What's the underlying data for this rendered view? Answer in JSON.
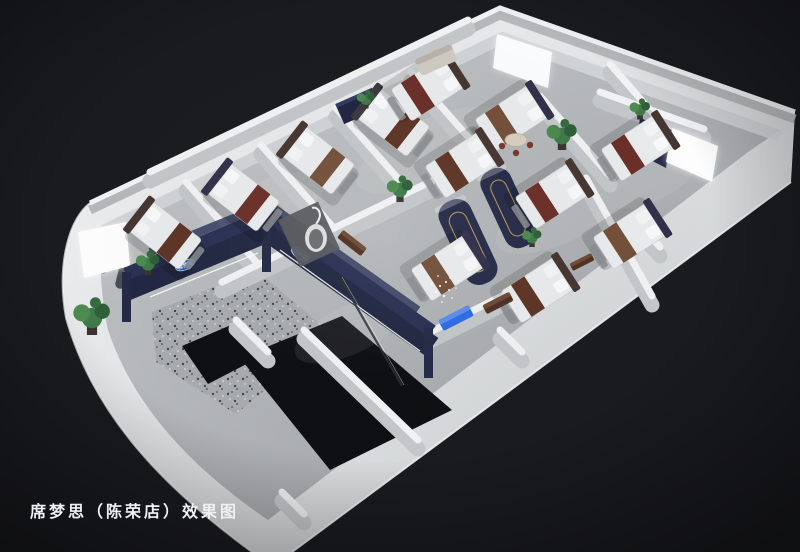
{
  "scene": {
    "type": "3d-cutaway-floorplan-rendering",
    "subject": "Overhead cutaway rendering of a mattress showroom with many bedroom displays",
    "brand": "席梦思",
    "branch": "陈荣店"
  },
  "caption": {
    "text": "席梦思（陈荣店）效果图"
  },
  "signage": {
    "logo_text": "席梦思",
    "logo_shape": "blue-oval",
    "logo_count": 2
  },
  "colors": {
    "background": "#1a1b1f",
    "outer_wall": "#e9ebec",
    "wall_top": "#f1f2f3",
    "wall_face": "#b5b8ba",
    "floor": "#b4b7b9",
    "fascia_navy": "#2a3153",
    "accent_navy": "#262c48",
    "logo_blue": "#2e6fdd",
    "bed_mattress": "#e9ebec",
    "bed_runner_brown": "#5e3526",
    "bed_runner_maroon": "#6b2f28",
    "plant_green": "#3f7a48",
    "bench_blue": "#2e6be5",
    "entry_floor_black": "#0e0f12",
    "terrazzo_gray": "#a8abad",
    "caption_text": "#eef0f2"
  },
  "elements": {
    "bed_display_count": 12,
    "lightbox_count": 3,
    "plant_count": 7
  }
}
